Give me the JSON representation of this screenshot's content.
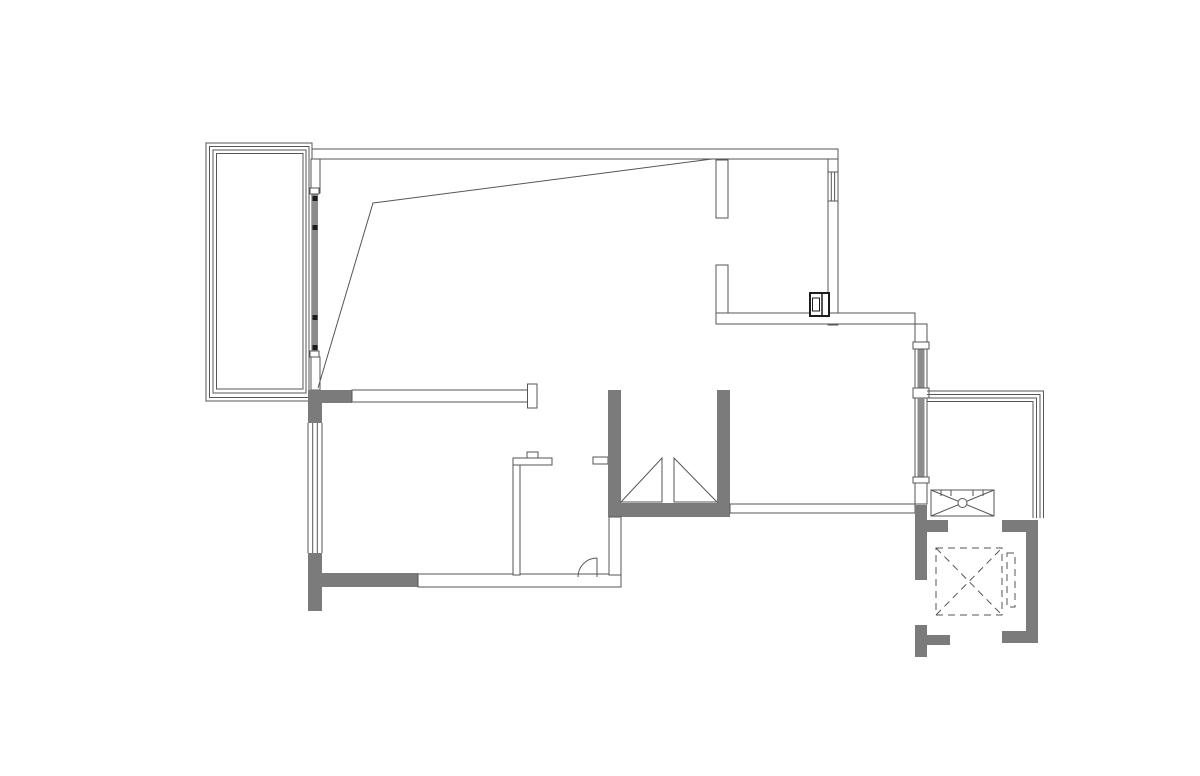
{
  "diagram": {
    "type": "architectural-floor-plan",
    "style": "CAD line drawing, no text labels visible",
    "elements": [
      "balcony-top-left",
      "main-living-space",
      "top-right-room",
      "sight-lines-diagonal",
      "sliding-window-mullion",
      "interior-partition-with-end-cap",
      "left-facade-window",
      "bathroom-partition",
      "bathroom-door-swing",
      "stair-duct-shaft-with-triangles",
      "wall-appliance-box",
      "corridor-walls",
      "right-facade-windows",
      "service-platform-thin-lines",
      "exhaust-fan-box-with-x",
      "elevator-shaft-dashed",
      "elevator-door-dashed",
      "elevator-lobby-walls"
    ]
  },
  "colors": {
    "background": "#ffffff",
    "line": "#565656",
    "wall": "#7b7b7b",
    "window": "#8c8c8c",
    "thick": "#1c1c1c"
  }
}
